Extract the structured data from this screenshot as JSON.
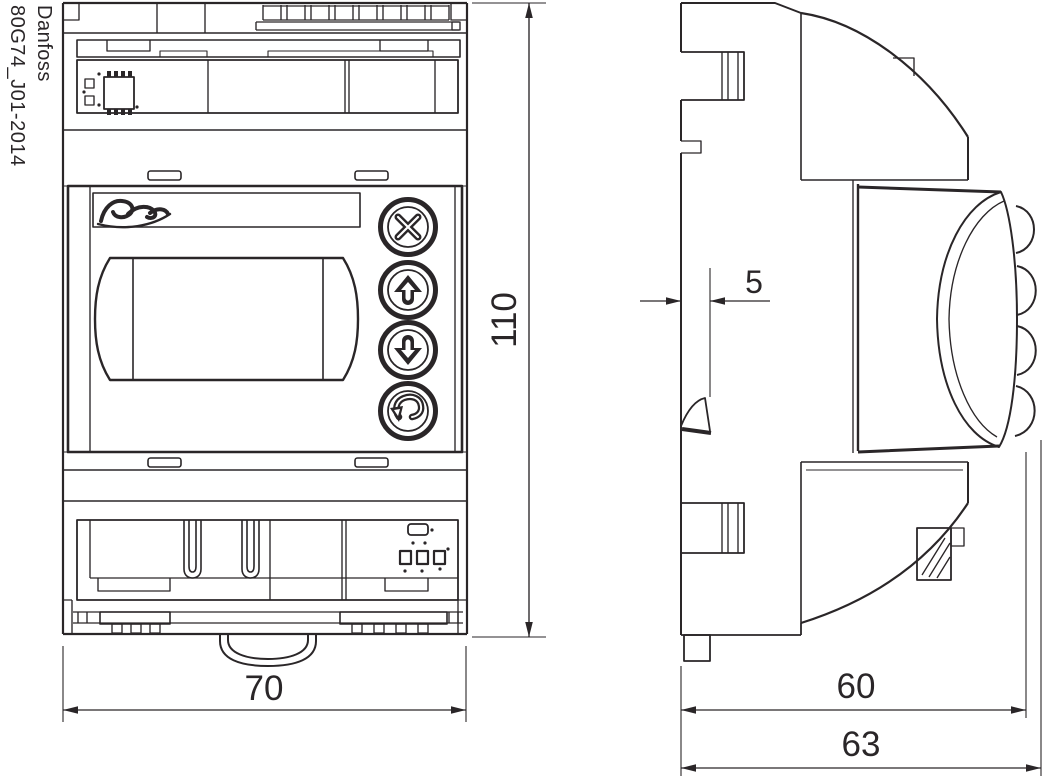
{
  "colors": {
    "ink": "#2a2628",
    "background": "#ffffff"
  },
  "watermark": {
    "brand": "Danfoss",
    "doc_id": "80G74_J01-2014"
  },
  "front_view": {
    "logo_script": "Danfoss",
    "dimensions": {
      "width_mm": "70",
      "height_mm": "110"
    },
    "buttons": [
      {
        "icon": "cancel-x-icon"
      },
      {
        "icon": "arrow-up-icon"
      },
      {
        "icon": "arrow-down-icon"
      },
      {
        "icon": "enter-icon"
      }
    ]
  },
  "side_view": {
    "dimensions": {
      "latch_offset_mm": "5",
      "body_depth_mm": "60",
      "overall_depth_mm": "63"
    }
  }
}
